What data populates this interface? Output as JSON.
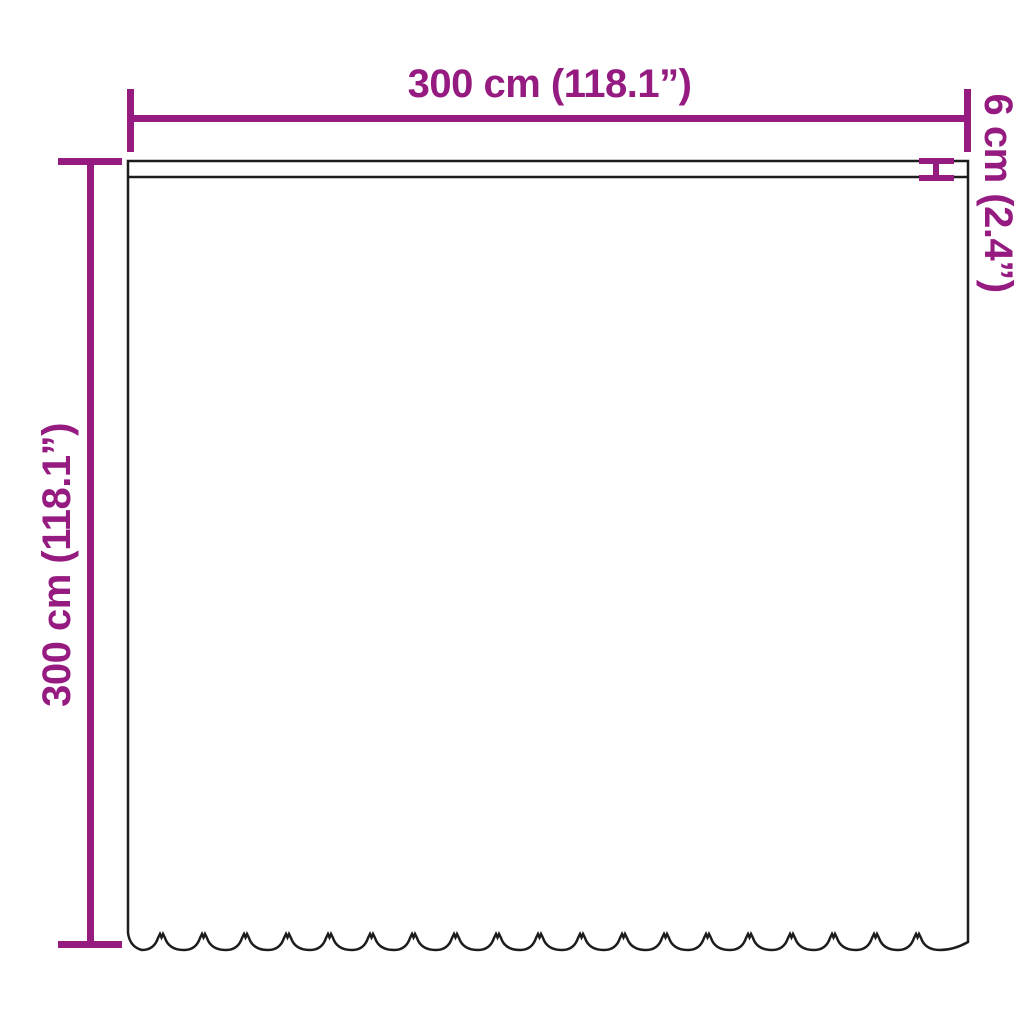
{
  "diagram": {
    "type": "product-dimension-diagram",
    "subject": "curtain with scalloped hem",
    "labels": {
      "width": "300 cm (118.1”)",
      "height": "300 cm (118.1”)",
      "hem": "6 cm (2.4”)"
    },
    "colors": {
      "dimension": "#951b81",
      "outline": "#1d1d1b",
      "background": "#ffffff"
    }
  }
}
